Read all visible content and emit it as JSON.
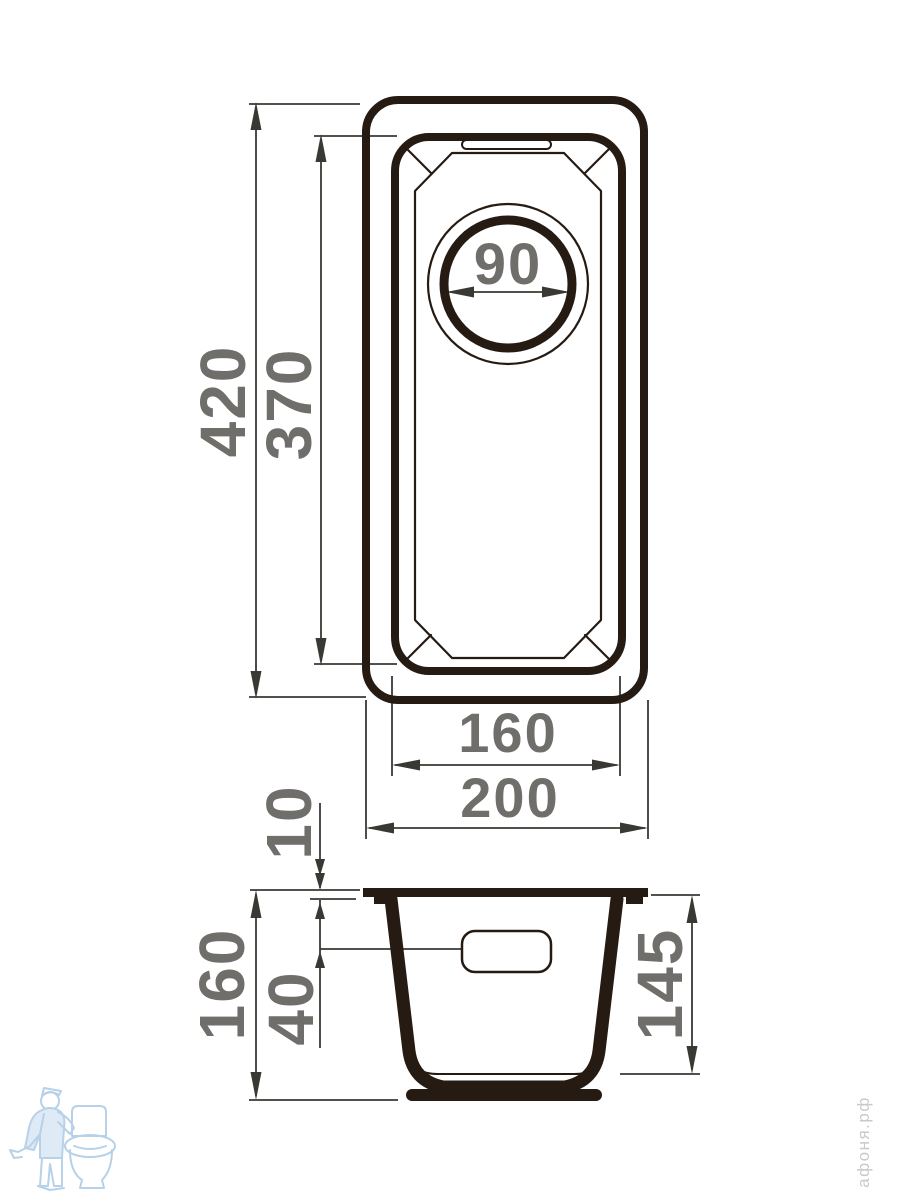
{
  "drawing": {
    "type": "sink-technical-drawing",
    "views": [
      "top-view",
      "side-section-view"
    ],
    "dimensions": {
      "top_view": {
        "overall_length": "420",
        "bowl_length": "370",
        "drain_diameter": "90",
        "bowl_width": "160",
        "overall_width": "200"
      },
      "side_view": {
        "rim_thickness": "10",
        "overall_height": "160",
        "overflow_offset": "40",
        "bowl_depth": "145"
      }
    },
    "colors": {
      "outline": "#261b13",
      "dimension_lines": "#3a3833",
      "labels": "#706e6b",
      "watermark_blue": "#aac9e4",
      "brand_text_gray": "#c9c9c9"
    },
    "watermark": {
      "icon": "plumber-with-toilet-icon",
      "brand_text": "афоня.рф"
    }
  }
}
